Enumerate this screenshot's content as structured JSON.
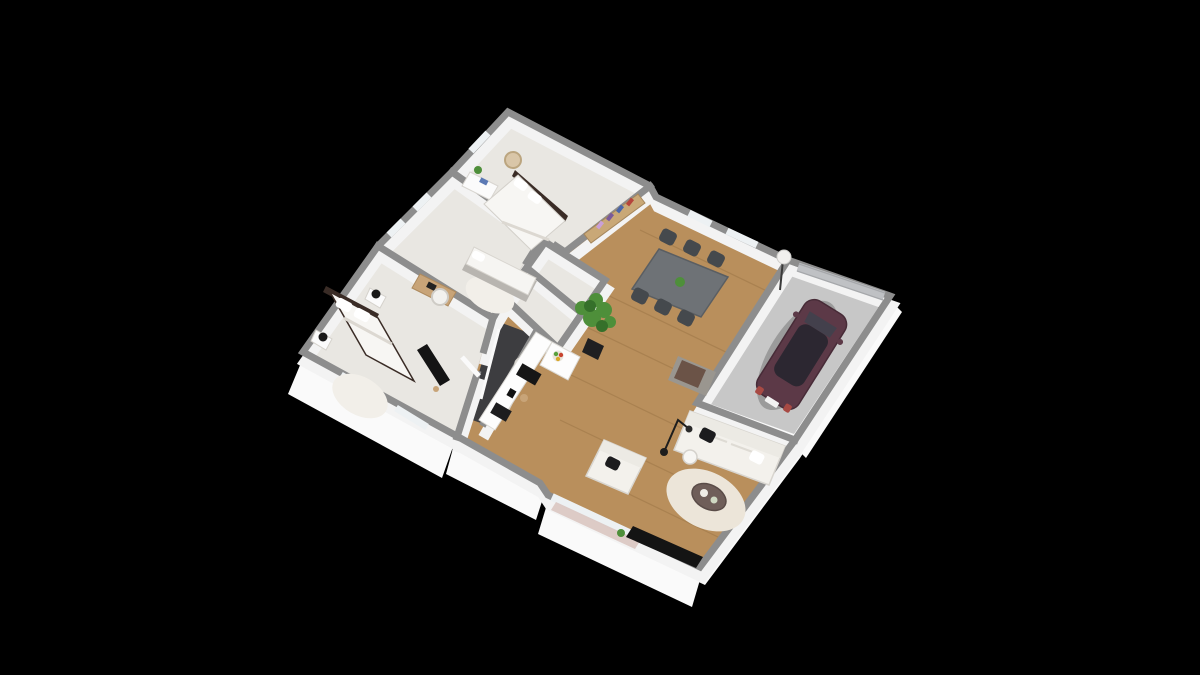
{
  "meta": {
    "description": "3D isometric dollhouse-style floor plan render of a single-storey house with attached garage, centered on a plain black background",
    "view": "isometric bird's-eye 3D cutaway, walls shown as gray tops with white faces",
    "background_note": "no text, labels or UI controls visible anywhere in the image"
  },
  "palette": {
    "background": "#000000",
    "slab": "#fafafa",
    "wall_top": "#8d8d8d",
    "wall_face": "#f3f3f3",
    "carpet": "#e9e7e2",
    "carpet_edge": "#d8d5cf",
    "wood": "#b98f5c",
    "plank_line": "rgba(90,58,20,0.16)",
    "garage_floor": "#c7c7c7",
    "bathroom_floor": "#3d3d40",
    "glass": "#edf1f3",
    "curtain": "#d8c3bd",
    "dining_table": "#6e7276",
    "chair_dark": "#45494d",
    "sofa_white": "#f3f1ec",
    "cushion_black": "#1c1c1e",
    "rug_round": "#ece5d9",
    "coffee_table": "#6f5e59",
    "car_body": "#5c3947",
    "car_glass": "#2c2731",
    "plant_green": "#4e8f3a",
    "plant_green_dark": "#35702a",
    "bookshelf_wood": "#c9a877",
    "bench_gray": "#9a968f",
    "throw_brown": "#6b5347",
    "tv_black": "#141414",
    "bed_frame": "#3a2c26",
    "desk_wood": "#c8a478",
    "garage_door": "#bfc1c4"
  },
  "scene": {
    "rooms": [
      {
        "name": "bedroom-top",
        "floor": "light carpet",
        "furniture": [
          "double bed with white duvet and dark headboard",
          "white dresser with small plant",
          "wooden chair",
          "colorful bookshelf on living-room side of wall"
        ]
      },
      {
        "name": "bedroom-middle",
        "floor": "light carpet",
        "furniture": [
          "white day bed with gray base",
          "wooden desk",
          "white desk chair",
          "small round rug"
        ],
        "windows": 2
      },
      {
        "name": "bedroom-master",
        "floor": "light carpet",
        "furniture": [
          "double bed with white duvet and dark frame",
          "two nightstands with black sphere lamps",
          "wall-mounted TV",
          "round rug"
        ],
        "windows": 2
      },
      {
        "name": "bathroom",
        "floor": "dark gray tile",
        "furniture": [
          "walk-in shower with glass panel",
          "washbasin",
          "toilet"
        ]
      },
      {
        "name": "hallway-closets",
        "floor": "carpet cells jutting into living space",
        "furniture": []
      },
      {
        "name": "kitchen",
        "floor": "wood",
        "furniture": [
          "white counter run with black cooktop and sink",
          "coffee machine",
          "island with fruit bowl"
        ]
      },
      {
        "name": "living-dining",
        "floor": "wood",
        "furniture": [
          "gray dining table with green centerpiece",
          "six dark chairs",
          "white ball floor lamp",
          "tall potted plant",
          "white sofa with black and white pillows",
          "white armchair with black pillow",
          "gray bench with brown throw",
          "black arc reading lamp",
          "white round side table",
          "round cream rug",
          "round dark coffee table with two plates",
          "black TV lowboard with small plant",
          "sliding glass door with rose curtains"
        ]
      },
      {
        "name": "garage",
        "floor": "concrete gray",
        "furniture": [
          "sectional garage door"
        ],
        "vehicle": "dark plum 5-door hatchback parked diagonally"
      }
    ],
    "counts": {
      "bedrooms": 3,
      "dining_chairs": 6,
      "floor_lamps": 2,
      "cars": 1
    }
  }
}
